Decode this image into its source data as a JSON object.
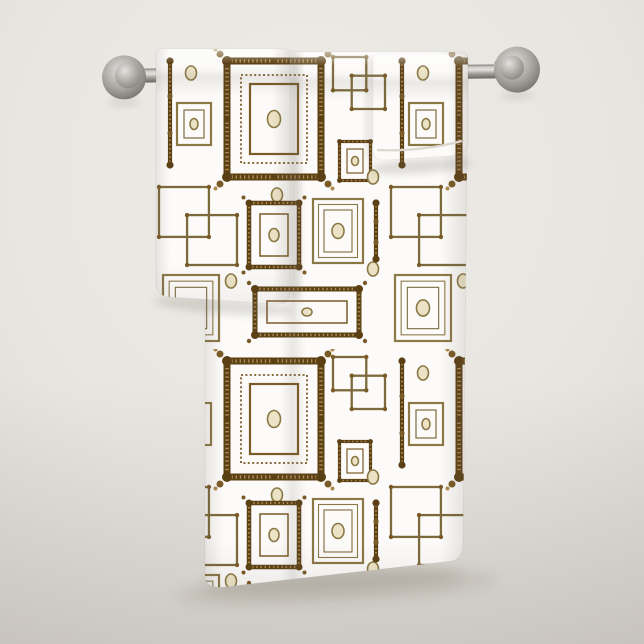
{
  "subject": "Bath towel set with vintage brown picture-frame pattern hanging on a brushed nickel towel bar against a plain light wall",
  "items": [
    {
      "label": "bath towel"
    },
    {
      "label": "hand towel"
    },
    {
      "label": "washcloth"
    }
  ],
  "rail": {
    "finish": "brushed nickel"
  },
  "palette": {
    "wall-base": "#e8e5e0",
    "wall-light": "#eeece8",
    "wall-dark": "#d8d4ce",
    "shadow": "#6e675c",
    "towel-white": "#fcfbf9",
    "hem": "#dcd8d0",
    "metal-hi": "#e4e2de",
    "metal-light": "#cfcdc9",
    "metal-mid": "#a8a5a1",
    "metal-dark": "#817e79",
    "metal-edge": "#6b6863"
  },
  "pattern": {
    "name": "ornate gold picture frames, interlocked squares and dots on white",
    "colors": {
      "dark": "#5c4015",
      "mid": "#7a5a26",
      "bead": "#ac8a4e",
      "olive": "#8a7845",
      "olive2": "#7c6a3c",
      "cream": "#ece3c6"
    },
    "tile": {
      "width": 232,
      "height": 300,
      "origin_x": 155,
      "origin_y": 49
    },
    "motifs": [
      {
        "type": "post",
        "x": 10,
        "y": 8,
        "w": 10,
        "h": 112
      },
      {
        "type": "dot",
        "x": 36,
        "y": 24
      },
      {
        "type": "simple-frame",
        "x": 22,
        "y": 54,
        "w": 34,
        "h": 42
      },
      {
        "type": "large-ornate-frame",
        "x": 64,
        "y": 4,
        "w": 110,
        "h": 132
      },
      {
        "type": "interlock-squares",
        "x": 178,
        "y": 8,
        "s": 52
      },
      {
        "type": "small-ornate-frame",
        "x": 182,
        "y": 90,
        "w": 36,
        "h": 44
      },
      {
        "type": "dot",
        "x": 122,
        "y": 146
      },
      {
        "type": "interlock-squares",
        "x": 4,
        "y": 138,
        "s": 78
      },
      {
        "type": "medium-ornate-frame",
        "x": 90,
        "y": 150,
        "w": 58,
        "h": 72
      },
      {
        "type": "striped-frame",
        "x": 158,
        "y": 150,
        "w": 50,
        "h": 64
      },
      {
        "type": "dot",
        "x": 218,
        "y": 128
      },
      {
        "type": "striped-frame",
        "x": 8,
        "y": 226,
        "w": 56,
        "h": 66
      },
      {
        "type": "wide-ornate-frame",
        "x": 96,
        "y": 236,
        "w": 112,
        "h": 54
      },
      {
        "type": "dot",
        "x": 76,
        "y": 232
      },
      {
        "type": "dot",
        "x": 218,
        "y": 220
      },
      {
        "type": "post",
        "x": 216,
        "y": 150,
        "w": 10,
        "h": 64
      }
    ]
  }
}
